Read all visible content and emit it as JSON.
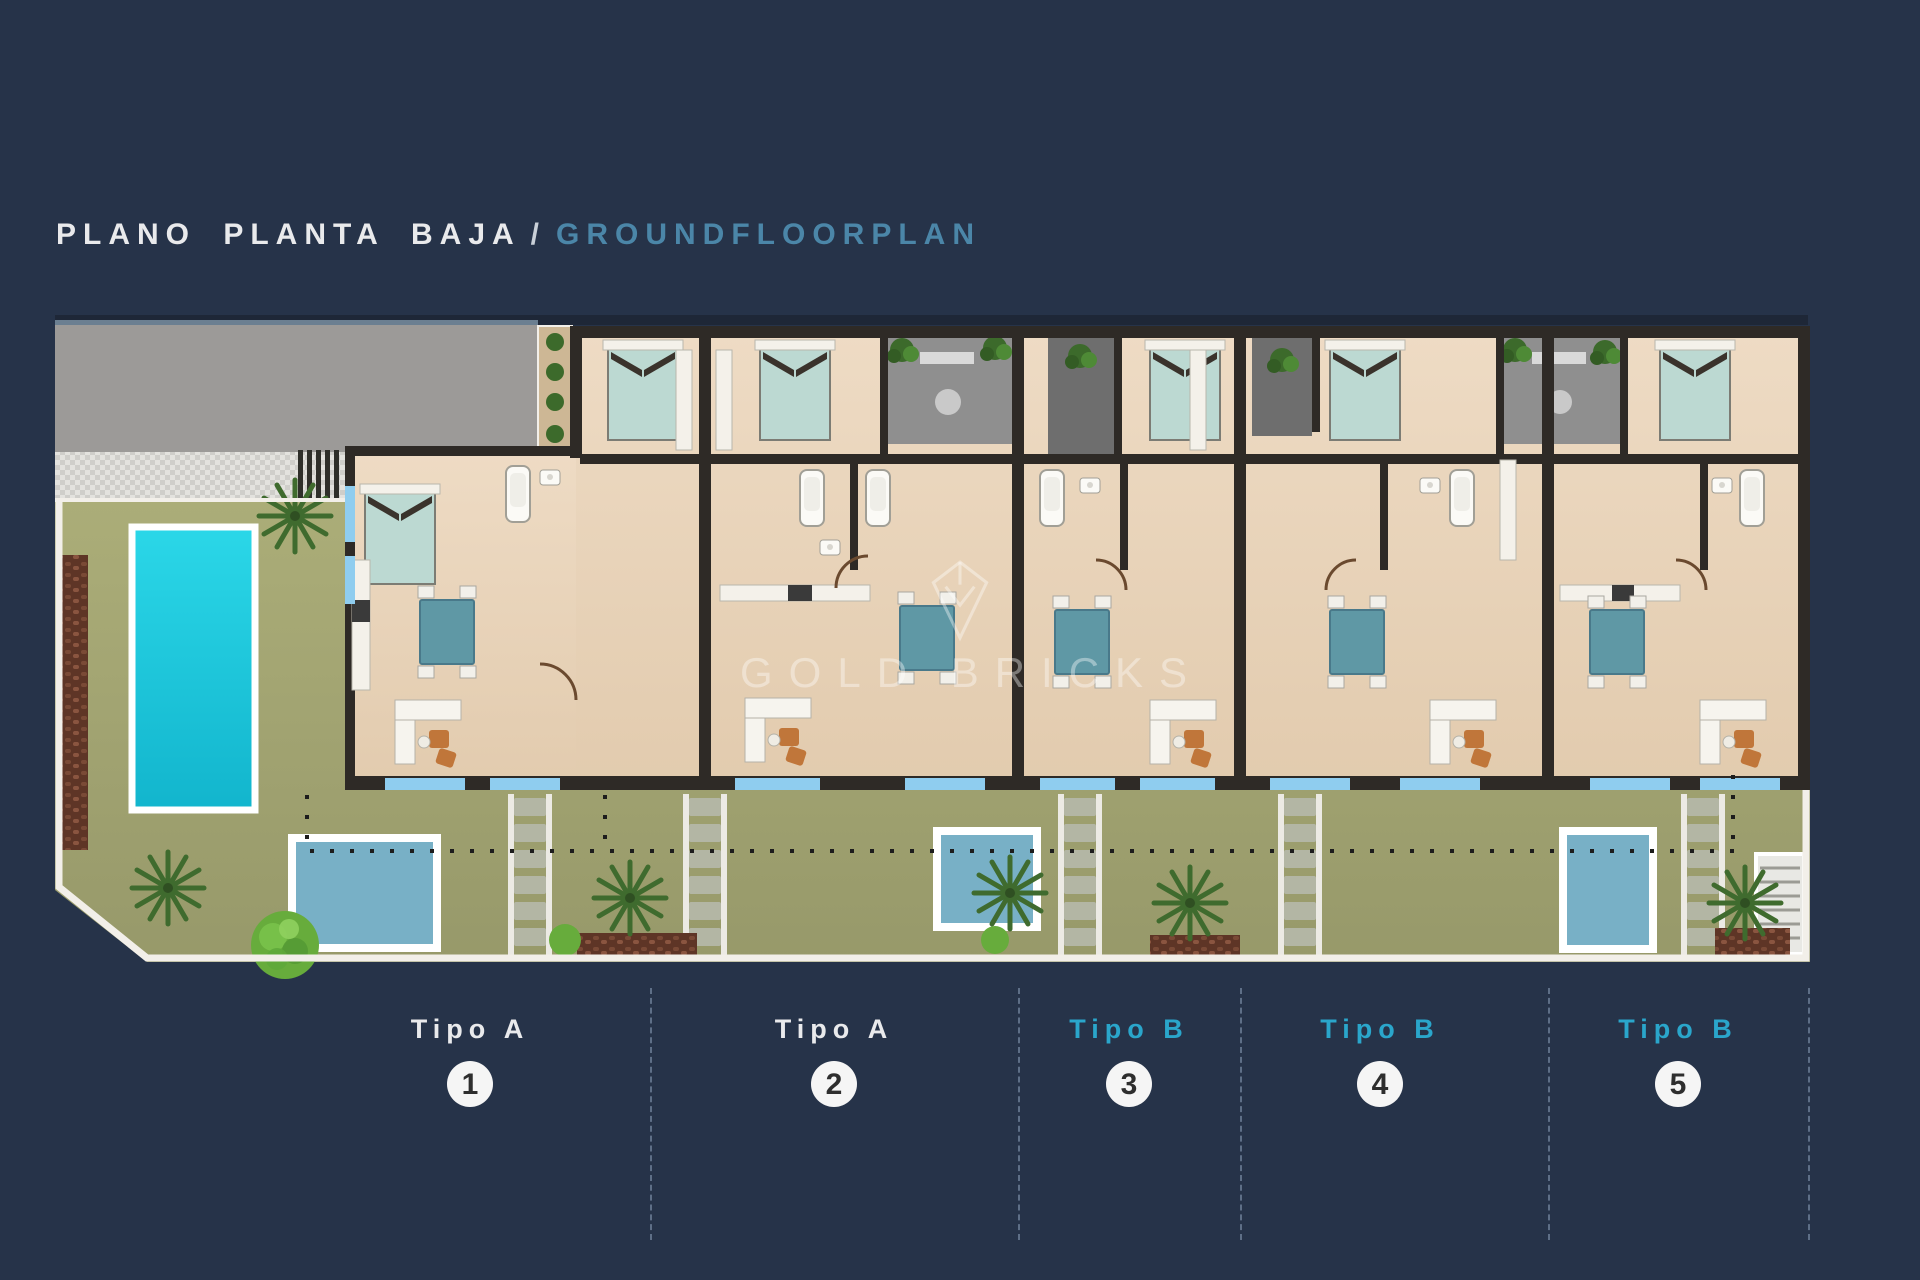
{
  "title": {
    "es": "PLANO PLANTA BAJA",
    "sep": "/",
    "en": "GROUNDFLOORPLAN"
  },
  "watermark": {
    "text": "GOLD BRICKS",
    "logo": "shield-diamond-logo"
  },
  "units": [
    {
      "label": "Tipo A",
      "number": "1",
      "type": "A"
    },
    {
      "label": "Tipo A",
      "number": "2",
      "type": "A"
    },
    {
      "label": "Tipo B",
      "number": "3",
      "type": "B"
    },
    {
      "label": "Tipo B",
      "number": "4",
      "type": "B"
    },
    {
      "label": "Tipo B",
      "number": "5",
      "type": "B"
    }
  ],
  "plan": {
    "features": [
      "large-pool",
      "plunge-pool-1",
      "plunge-pool-2",
      "plunge-pool-5",
      "garden",
      "driveway",
      "stepping-stones",
      "stairs",
      "palm-trees",
      "five-apartments",
      "bedrooms",
      "bathrooms",
      "dining-tables",
      "sofas"
    ]
  },
  "colors": {
    "background": "#263349",
    "top-strip": "#1e2737",
    "title-primary": "#e9eaec",
    "title-separator": "#c9d0d8",
    "title-secondary": "#4b86a8",
    "tipo-a": "#e9eaec",
    "tipo-b": "#2aa6cb",
    "circle-bg": "#f5f5f5",
    "circle-text": "#2e2e2e",
    "curb": "#f2efe9",
    "garden-light": "#abad78",
    "garden-dark": "#97996a",
    "driveway": "#9c9a98",
    "hatch-light": "#e3e2de",
    "hatch-dark": "#cfceca",
    "floor-light": "#eedbc4",
    "floor-dark": "#e2cbae",
    "wall": "#2e2a26",
    "window": "#8fcdef",
    "patio": "#8f8f8f",
    "patio-dark": "#6e6e6e",
    "pool-large-light": "#2bd7e8",
    "pool-large-dark": "#12b5cd",
    "pool-small": "#78b0c6",
    "bed": "#bcd9d2",
    "headboard": "#3a332c",
    "table": "#5f98a5",
    "chair": "#f2f0ea",
    "sofa": "#f6f4ee",
    "sofa-accent": "#c0763a",
    "palm": "#3f6b2e",
    "bush": "#67ac3c",
    "mulch": "#7a4a36",
    "stone": "#b3b6a4",
    "stair": "#e8e8e4",
    "door": "#6b4a2f",
    "dot-line": "#1d1d1d",
    "dashed-line": "#8ca0ba",
    "plant-strip": "#cdb795",
    "watermark-color": "rgba(255,255,255,0.38)"
  }
}
